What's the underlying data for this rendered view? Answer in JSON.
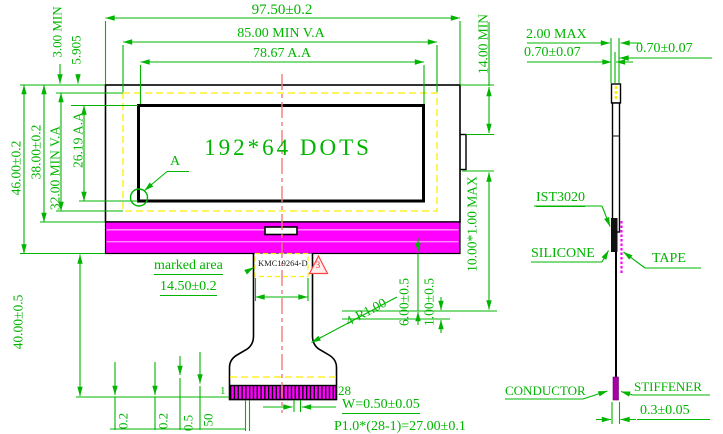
{
  "front": {
    "display_area_text": "192*64 DOTS",
    "top_dims": [
      "97.50±0.2",
      "85.00 MIN V.A",
      "78.67 A.A"
    ],
    "left_dims": [
      "46.00±0.2",
      "38.00±0.2",
      "32.00 MIN V.A",
      "26.19 A.A"
    ],
    "top_left_dims": [
      "3.00 MIN",
      "5.905"
    ],
    "right_ledge_dim": "14.00 MIN",
    "right_bend_dim": "10.00*1.00 MAX",
    "fpc_dims": [
      "6.00±0.5",
      "1.00±0.5"
    ],
    "tail_length_dim": "40.00±0.5",
    "detail_callout": "A",
    "marked_area_label": "marked area",
    "marked_area_width_dim": "14.50±0.2",
    "part_number": "KMC19264-D",
    "revision_triangle": "3",
    "corner_radius_dim": "4-R1.00",
    "pin_first": "1",
    "pin_last": "28",
    "pin_width_dim": "W=0.50±0.05",
    "pitch_dim": "P1.0*(28-1)=27.00±0.1",
    "bottom_cut_dims": [
      "0.2",
      "0.2",
      "0.5",
      "50"
    ]
  },
  "side": {
    "thickness_dim": "2.00 MAX",
    "glass_dim_left": "0.70±0.07",
    "glass_dim_right": "0.70±0.07",
    "ic_label": "IST3020",
    "silicone_label": "SILICONE",
    "tape_label": "TAPE",
    "conductor_label": "CONDUCTOR",
    "stiffener_label": "STIFFENER",
    "stiffener_thickness_dim": "0.3±0.05"
  },
  "colors": {
    "dimension_green": "#00b400",
    "backlight_magenta": "#ff00ff",
    "viewing_area_yellow": "#ffee00",
    "centerline_red": "#f27a7a",
    "revision_red": "#ff4444"
  }
}
